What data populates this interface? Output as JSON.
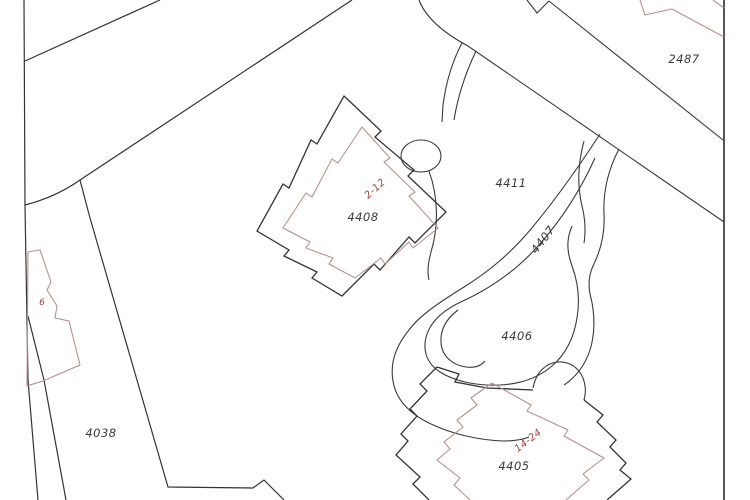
{
  "map": {
    "type": "cadastral-parcel-map",
    "background": "#ffffff",
    "colors": {
      "parcel_line": "#333333",
      "road_line": "#3a3a3a",
      "building_line": "#b5928f",
      "boundary_line": "#2b2b2b",
      "label_dark": "#3a3a3a",
      "label_red": "#a8423e"
    },
    "labels": [
      {
        "id": "parcel-2487",
        "text": "2487",
        "x": 684,
        "y": 63,
        "color": "dark",
        "rotation": 0
      },
      {
        "id": "parcel-4411",
        "text": "4411",
        "x": 511,
        "y": 187,
        "color": "dark",
        "rotation": 0
      },
      {
        "id": "parcel-4408",
        "text": "4408",
        "x": 363,
        "y": 221,
        "color": "dark",
        "rotation": 0
      },
      {
        "id": "building-2-12",
        "text": "2-12",
        "x": 377,
        "y": 191,
        "color": "red",
        "rotation": -42
      },
      {
        "id": "road-4407",
        "text": "4407",
        "x": 546,
        "y": 242,
        "color": "dark",
        "rotation": -52
      },
      {
        "id": "parcel-4406",
        "text": "4406",
        "x": 517,
        "y": 340,
        "color": "dark",
        "rotation": 0
      },
      {
        "id": "parcel-4405",
        "text": "4405",
        "x": 514,
        "y": 470,
        "color": "dark",
        "rotation": 0
      },
      {
        "id": "building-14-24",
        "text": "14-24",
        "x": 530,
        "y": 443,
        "color": "red",
        "rotation": -38
      },
      {
        "id": "parcel-4038",
        "text": "4038",
        "x": 101,
        "y": 437,
        "color": "dark",
        "rotation": 0
      },
      {
        "id": "building-6",
        "text": "6",
        "x": 42,
        "y": 305,
        "color": "red",
        "rotation": 0
      }
    ]
  }
}
